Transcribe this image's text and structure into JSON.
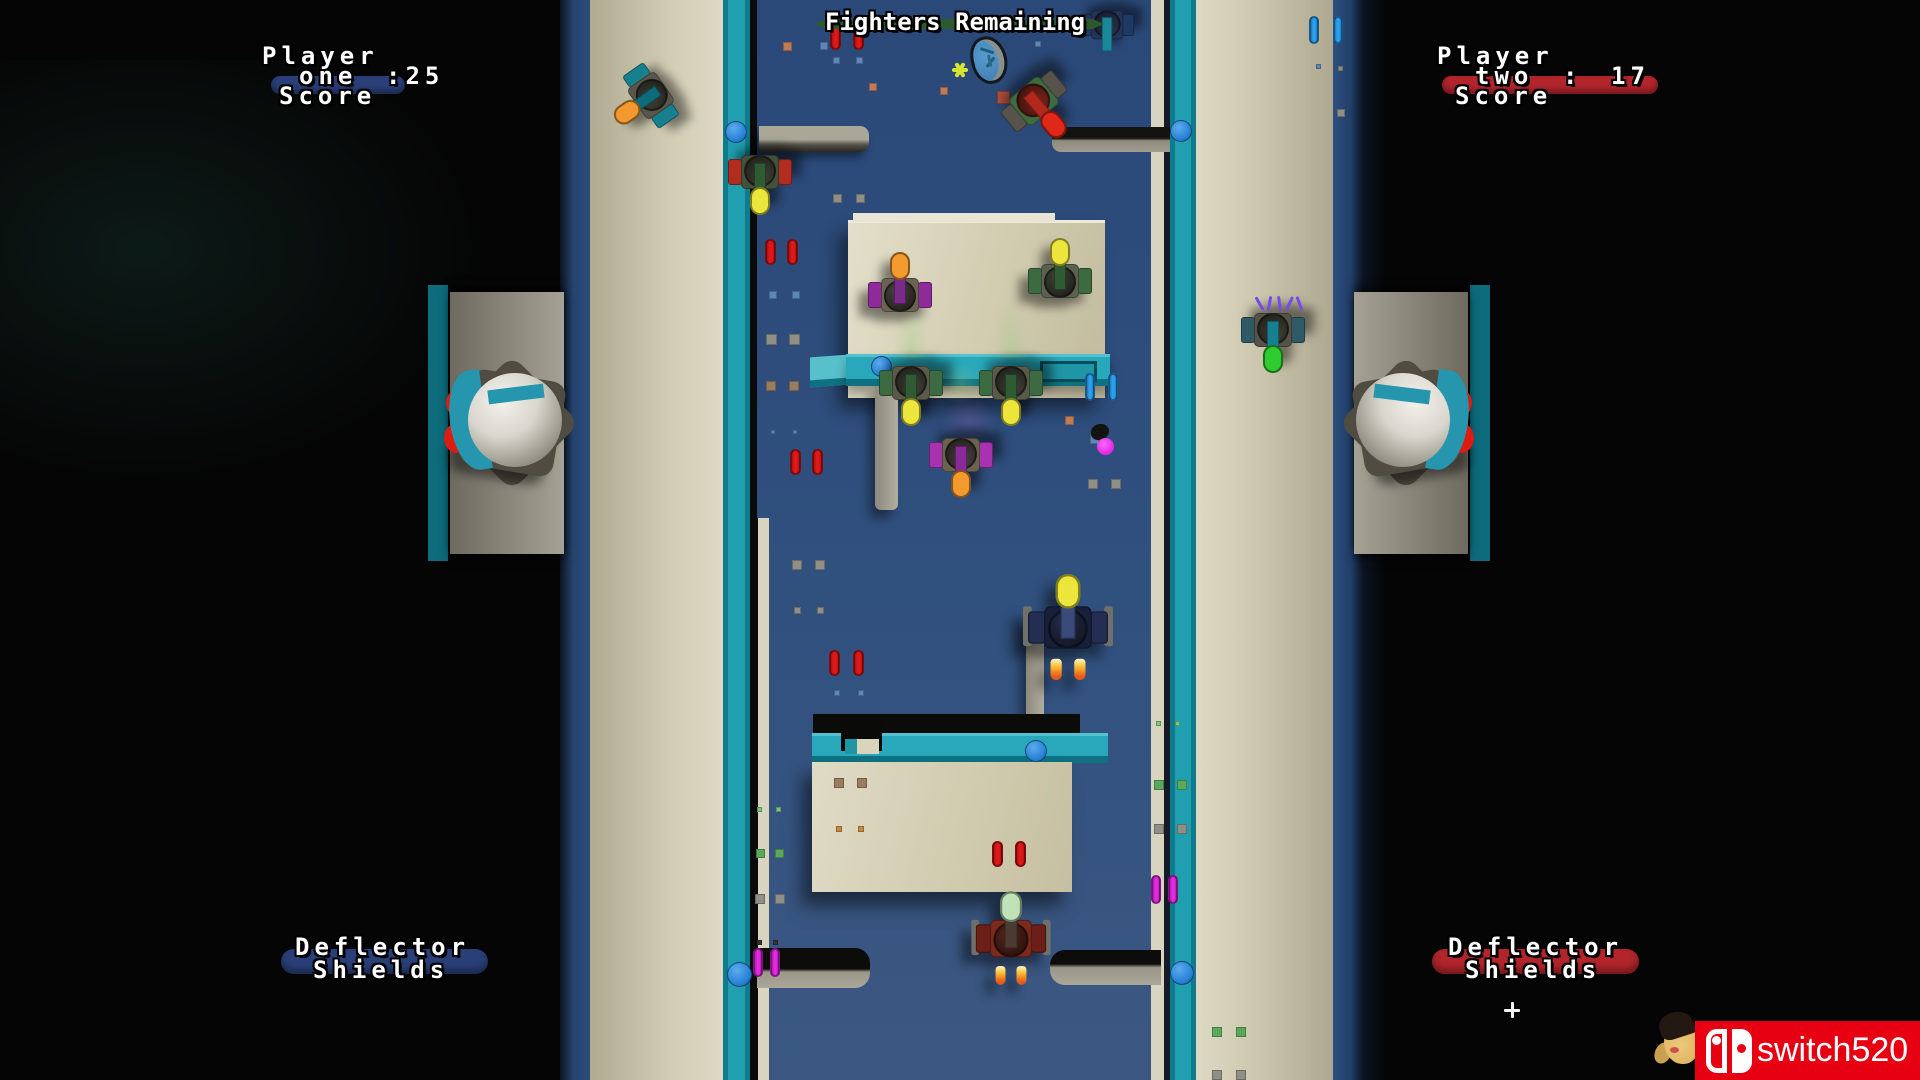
{
  "hud": {
    "fighters_remaining": {
      "label": "Fighters Remaining",
      "bar_color": "#2d5a2d"
    },
    "player_one": {
      "title": "Player",
      "name": "one",
      "score": ":25",
      "caption": "Score",
      "bar_color": "#2a3f78"
    },
    "player_two": {
      "title": "Player",
      "name": "two",
      "colon": ":",
      "score": "17",
      "caption": "Score",
      "bar_color": "#b1252b"
    },
    "deflector_left": {
      "line1": "Deflector",
      "line2": "Shields",
      "bar_color": "#2a3f78"
    },
    "deflector_right": {
      "line1": "Deflector",
      "line2": "Shields",
      "bar_color": "#b1252b"
    }
  },
  "watermark": {
    "text": "switch520",
    "bg_color": "#e60012"
  },
  "palette": {
    "background": "#050505",
    "arena_top": "#2a4878",
    "arena_bottom": "#3c5882",
    "teal_rail": "#1f9fb0",
    "tan_wall": "#cdc7ac",
    "red_pill": "#e01818",
    "blue_pill": "#2aa0f0",
    "magenta_pill": "#e428e4",
    "yellow_bubble": "#ece63c",
    "orange_bubble": "#f29a2e"
  },
  "scene": {
    "tanks": [
      {
        "name": "purple-tank-upper",
        "x": 900,
        "y": 289,
        "rot": 0,
        "scale": 1,
        "wing": "#8e2a9a",
        "body": "#6a6352",
        "barrel": "#7a2a88",
        "bubble": "#f29a2e",
        "cockpit": "#45413a"
      },
      {
        "name": "green-tank-upper",
        "x": 1060,
        "y": 275,
        "rot": 0,
        "scale": 1,
        "wing": "#3c6b42",
        "body": "#5a6150",
        "barrel": "#2e5a34",
        "bubble": "#ece63c",
        "cockpit": "#3f3f35"
      },
      {
        "name": "green-tank-mid-left",
        "x": 911,
        "y": 389,
        "rot": 180,
        "scale": 1,
        "wing": "#3c6b42",
        "body": "#5a5a4a",
        "barrel": "#2e5a34",
        "bubble": "#ece63c",
        "cockpit": "#3f3f35"
      },
      {
        "name": "green-tank-mid-right",
        "x": 1011,
        "y": 389,
        "rot": 180,
        "scale": 1,
        "wing": "#3c6b42",
        "body": "#5a5a4a",
        "barrel": "#2e5a34",
        "bubble": "#ece63c",
        "cockpit": "#3f3f35"
      },
      {
        "name": "purple-tank-lower",
        "x": 961,
        "y": 461,
        "rot": 180,
        "scale": 1,
        "wing": "#a832b0",
        "body": "#6a6352",
        "barrel": "#8a2a98",
        "bubble": "#f29a2e",
        "cockpit": "#45413a"
      },
      {
        "name": "red-green-tank-left",
        "x": 760,
        "y": 178,
        "rot": 180,
        "scale": 1,
        "wing": "#b22c20",
        "body": "#44503a",
        "barrel": "#2e5a34",
        "bubble": "#ece63c",
        "cockpit": "#3f3f35"
      },
      {
        "name": "enemy-ship-top-right",
        "x": 1038,
        "y": 106,
        "rot": 140,
        "scale": 1.05,
        "wing": "#57534a",
        "body": "#3e6b40",
        "barrel": "#b2281c",
        "bubble": "#e02818",
        "cockpit": "#7a241a"
      },
      {
        "name": "teal-ship-top-left",
        "x": 646,
        "y": 99,
        "rot": -125,
        "scale": 1,
        "wing": "#17808f",
        "body": "#5a564c",
        "barrel": "#0e6b7a",
        "bubble": "#f29a2e",
        "cockpit": "#3f3f35"
      },
      {
        "name": "damaged-ship-right",
        "x": 1273,
        "y": 336,
        "rot": 180,
        "scale": 1,
        "wing": "#2e5a68",
        "body": "#56524a",
        "barrel": "#17808f",
        "bubble": "#2ecc2e",
        "cockpit": "#3f3f35"
      },
      {
        "name": "blue-tank-corner",
        "x": 1107,
        "y": 30,
        "rot": 180,
        "scale": 0.85,
        "wing": "#1d3a66",
        "body": "#223458",
        "barrel": "#1a8898",
        "bubble": null,
        "cockpit": "#2a3450"
      },
      {
        "name": "fighter-ship-center",
        "x": 1068,
        "y": 620,
        "rot": 0,
        "scale": 1.25,
        "wing": "#232e52",
        "body": "#171f3a",
        "barrel": "#3a4a7a",
        "bubble": "#ece63c",
        "cockpit": "#222a46",
        "flames": true,
        "pods": true
      },
      {
        "name": "red-ship-bottom",
        "x": 1011,
        "y": 932,
        "rot": 0,
        "scale": 1.1,
        "wing": "#6b1f16",
        "body": "#7c2a1c",
        "barrel": "#4a3a32",
        "bubble": "#bfe2b8",
        "cockpit": "#55221a",
        "flames": true,
        "pods": true
      }
    ],
    "pills": [
      {
        "x": 830,
        "y": 24,
        "type": "red"
      },
      {
        "x": 853,
        "y": 24,
        "type": "red"
      },
      {
        "x": 765,
        "y": 239,
        "type": "red"
      },
      {
        "x": 787,
        "y": 239,
        "type": "red"
      },
      {
        "x": 790,
        "y": 449,
        "type": "red"
      },
      {
        "x": 812,
        "y": 449,
        "type": "red"
      },
      {
        "x": 829,
        "y": 650,
        "type": "red"
      },
      {
        "x": 853,
        "y": 650,
        "type": "red"
      },
      {
        "x": 992,
        "y": 841,
        "type": "red"
      },
      {
        "x": 1015,
        "y": 841,
        "type": "red"
      },
      {
        "x": 1085,
        "y": 373,
        "type": "blue"
      },
      {
        "x": 1108,
        "y": 373,
        "type": "blue"
      },
      {
        "x": 1309,
        "y": 16,
        "type": "blue"
      },
      {
        "x": 1333,
        "y": 16,
        "type": "blue"
      },
      {
        "x": 753,
        "y": 948,
        "type": "magenta"
      },
      {
        "x": 770,
        "y": 948,
        "type": "magenta"
      },
      {
        "x": 1151,
        "y": 875,
        "type": "magenta"
      },
      {
        "x": 1168,
        "y": 875,
        "type": "magenta"
      }
    ],
    "pill_types": {
      "red": {
        "w": 11,
        "h": 26,
        "color": "#e01818"
      },
      "blue": {
        "w": 10,
        "h": 28,
        "color": "#2aa0f0"
      },
      "magenta": {
        "w": 10,
        "h": 29,
        "color": "#e428e4"
      }
    },
    "portals": [
      {
        "x": 725,
        "y": 121,
        "d": 22
      },
      {
        "x": 1170,
        "y": 120,
        "d": 22
      },
      {
        "x": 871,
        "y": 356,
        "d": 21
      },
      {
        "x": 1025,
        "y": 740,
        "d": 22
      },
      {
        "x": 727,
        "y": 962,
        "d": 25
      },
      {
        "x": 1170,
        "y": 961,
        "d": 24
      }
    ],
    "particles": [
      [
        783,
        42,
        9,
        "#bf7a58"
      ],
      [
        869,
        83,
        8,
        "#bf7a58"
      ],
      [
        940,
        87,
        8,
        "#bf7a58"
      ],
      [
        1065,
        416,
        9,
        "#bf7a58"
      ],
      [
        997,
        91,
        13,
        "#b5503c"
      ],
      [
        820,
        42,
        8,
        "#5d87b8"
      ],
      [
        833,
        57,
        7,
        "#5d87b8"
      ],
      [
        856,
        57,
        7,
        "#5d87b8"
      ],
      [
        1035,
        41,
        6,
        "#5d87b8"
      ],
      [
        769,
        291,
        8,
        "#5d87b8"
      ],
      [
        792,
        291,
        8,
        "#5d87b8"
      ],
      [
        1090,
        435,
        9,
        "#5d87b8"
      ],
      [
        834,
        690,
        6,
        "#5d87b8"
      ],
      [
        858,
        690,
        6,
        "#5d87b8"
      ],
      [
        771,
        430,
        4,
        "#5d87b8"
      ],
      [
        793,
        430,
        4,
        "#5d87b8"
      ],
      [
        1316,
        64,
        5,
        "#5d87b8"
      ],
      [
        833,
        194,
        9,
        "#8f8f87"
      ],
      [
        856,
        194,
        9,
        "#8f8f87"
      ],
      [
        766,
        334,
        11,
        "#8f8f87"
      ],
      [
        789,
        334,
        11,
        "#8f8f87"
      ],
      [
        792,
        560,
        10,
        "#8f8f87"
      ],
      [
        815,
        560,
        10,
        "#8f8f87"
      ],
      [
        794,
        607,
        7,
        "#8f8f87"
      ],
      [
        817,
        607,
        7,
        "#8f8f87"
      ],
      [
        1088,
        479,
        10,
        "#8f8f87"
      ],
      [
        1111,
        479,
        10,
        "#8f8f87"
      ],
      [
        1154,
        824,
        10,
        "#8f8f87"
      ],
      [
        1177,
        824,
        10,
        "#8f8f87"
      ],
      [
        755,
        894,
        10,
        "#8f8f87"
      ],
      [
        775,
        894,
        10,
        "#8f8f87"
      ],
      [
        1212,
        1070,
        10,
        "#8f8f87"
      ],
      [
        1236,
        1070,
        10,
        "#8f8f87"
      ],
      [
        1338,
        66,
        5,
        "#8f8f87"
      ],
      [
        1337,
        109,
        8,
        "#8f8f87"
      ],
      [
        766,
        381,
        10,
        "#9c7c5e"
      ],
      [
        789,
        381,
        10,
        "#9c7c5e"
      ],
      [
        834,
        778,
        10,
        "#9c7c5e"
      ],
      [
        857,
        778,
        10,
        "#9c7c5e"
      ],
      [
        836,
        826,
        6,
        "#c8883e"
      ],
      [
        858,
        826,
        6,
        "#c8883e"
      ],
      [
        1154,
        780,
        10,
        "#5aa85a"
      ],
      [
        1177,
        780,
        10,
        "#5aa85a"
      ],
      [
        756,
        849,
        9,
        "#5aa85a"
      ],
      [
        775,
        849,
        9,
        "#5aa85a"
      ],
      [
        1212,
        1027,
        10,
        "#5aa85a"
      ],
      [
        1236,
        1027,
        10,
        "#5aa85a"
      ],
      [
        757,
        807,
        5,
        "#7ac87a"
      ],
      [
        776,
        807,
        5,
        "#7ac87a"
      ],
      [
        1156,
        721,
        5,
        "#7ac87a"
      ],
      [
        1175,
        721,
        5,
        "#7ac87a"
      ],
      [
        1035,
        385,
        8,
        "#7ac87a"
      ],
      [
        757,
        940,
        5,
        "#33332e"
      ],
      [
        773,
        940,
        5,
        "#33332e"
      ]
    ],
    "effects": [
      {
        "type": "plume",
        "x": 893,
        "y": 296,
        "w": 36,
        "h": 62
      },
      {
        "type": "plume",
        "x": 993,
        "y": 296,
        "w": 36,
        "h": 62
      },
      {
        "type": "blob-green",
        "x": 935,
        "y": 362,
        "w": 48,
        "h": 42
      },
      {
        "type": "blob-purple",
        "x": 940,
        "y": 398,
        "w": 58,
        "h": 48
      },
      {
        "type": "sparks",
        "x": 1256,
        "y": 292
      },
      {
        "type": "burst",
        "x": 950,
        "y": 60
      },
      {
        "type": "splat",
        "x": 1091,
        "y": 424
      },
      {
        "type": "ball",
        "x": 1097,
        "y": 438,
        "d": 17,
        "color": "#e428e4"
      },
      {
        "type": "sparkle",
        "x": 1504,
        "y": 1002
      }
    ],
    "asteroid": {
      "x": 971,
      "y": 36,
      "w": 36,
      "h": 48
    }
  }
}
